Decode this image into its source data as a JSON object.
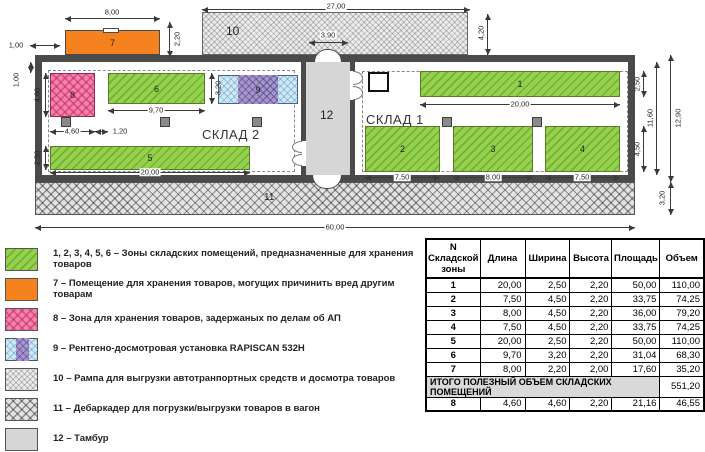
{
  "plan": {
    "room_labels": {
      "sklad1": "СКЛАД 1",
      "sklad2": "СКЛАД 2"
    },
    "zones": {
      "z1": "1",
      "z2": "2",
      "z3": "3",
      "z4": "4",
      "z5": "5",
      "z6": "6",
      "z7": "7",
      "z8": "8",
      "z9": "9",
      "z10": "10",
      "z11": "11",
      "z12": "12"
    },
    "dims": {
      "d800": "8,00",
      "d220": "2,20",
      "d100_top": "1,00",
      "d2700": "27,00",
      "d390": "3,90",
      "d420": "4,20",
      "d100_left": "1,00",
      "d460_v": "4,60",
      "d460_h": "4,60",
      "d120": "1,20",
      "d970": "9,70",
      "d320_z6": "3,20",
      "d250_z5": "2,50",
      "d2000_z5": "20,00",
      "d2000_z1": "20,00",
      "d250_r": "2,50",
      "d450_r": "4,50",
      "d1160": "11,60",
      "d1290": "12,90",
      "d320_r": "3,20",
      "d750_z2": "7,50",
      "d800_z3": "8,00",
      "d750_z4": "7,50",
      "d6000": "60,00"
    }
  },
  "legend": {
    "items": [
      {
        "id": "zones-1-6",
        "text": "1, 2, 3, 4, 5, 6 – Зоны складских помещений, предназначенные для хранения товаров"
      },
      {
        "id": "zone-7",
        "text": "7 – Помещение для хранения товаров, могущих причинить вред другим товарам"
      },
      {
        "id": "zone-8",
        "text": "8 – Зона для хранения товаров, задержаных по делам об АП"
      },
      {
        "id": "zone-9",
        "text": "9  – Рентгено-досмотровая установка RAPISCAN 532H"
      },
      {
        "id": "zone-10",
        "text": "10  – Рампа для выгрузки автотранпортных средств и досмотра товаров"
      },
      {
        "id": "zone-11",
        "text": "11 – Дебаркадер для погрузки/выгрузки товаров в вагон"
      },
      {
        "id": "zone-12",
        "text": "12 – Тамбур"
      }
    ]
  },
  "table": {
    "headers": [
      "N Складской зоны",
      "Длина",
      "Ширина",
      "Высота",
      "Площадь",
      "Объем"
    ],
    "rows": [
      [
        "1",
        "20,00",
        "2,50",
        "2,20",
        "50,00",
        "110,00"
      ],
      [
        "2",
        "7,50",
        "4,50",
        "2,20",
        "33,75",
        "74,25"
      ],
      [
        "3",
        "8,00",
        "4,50",
        "2,20",
        "36,00",
        "79,20"
      ],
      [
        "4",
        "7,50",
        "4,50",
        "2,20",
        "33,75",
        "74,25"
      ],
      [
        "5",
        "20,00",
        "2,50",
        "2,20",
        "50,00",
        "110,00"
      ],
      [
        "6",
        "9,70",
        "3,20",
        "2,20",
        "31,04",
        "68,30"
      ],
      [
        "7",
        "8,00",
        "2,20",
        "2,00",
        "17,60",
        "35,20"
      ]
    ],
    "total_label": "ИТОГО ПОЛЕЗНЫЙ ОБЪЕМ СКЛАДСКИХ ПОМЕЩЕНИЙ",
    "total_value": "551,20",
    "row8": [
      "8",
      "4,60",
      "4,60",
      "2,20",
      "21,16",
      "46,55"
    ]
  },
  "colors": {
    "zone_green": "#95d04e",
    "hazard_orange": "#f5821f",
    "detained_pink": "#f584ad",
    "xray_blue": "#cfe9f7",
    "xray_purple": "#a597cb",
    "wall_gray": "#4a4a4a",
    "tambour_gray": "#d6d6d6",
    "total_row_gray": "#d9d9d9"
  }
}
